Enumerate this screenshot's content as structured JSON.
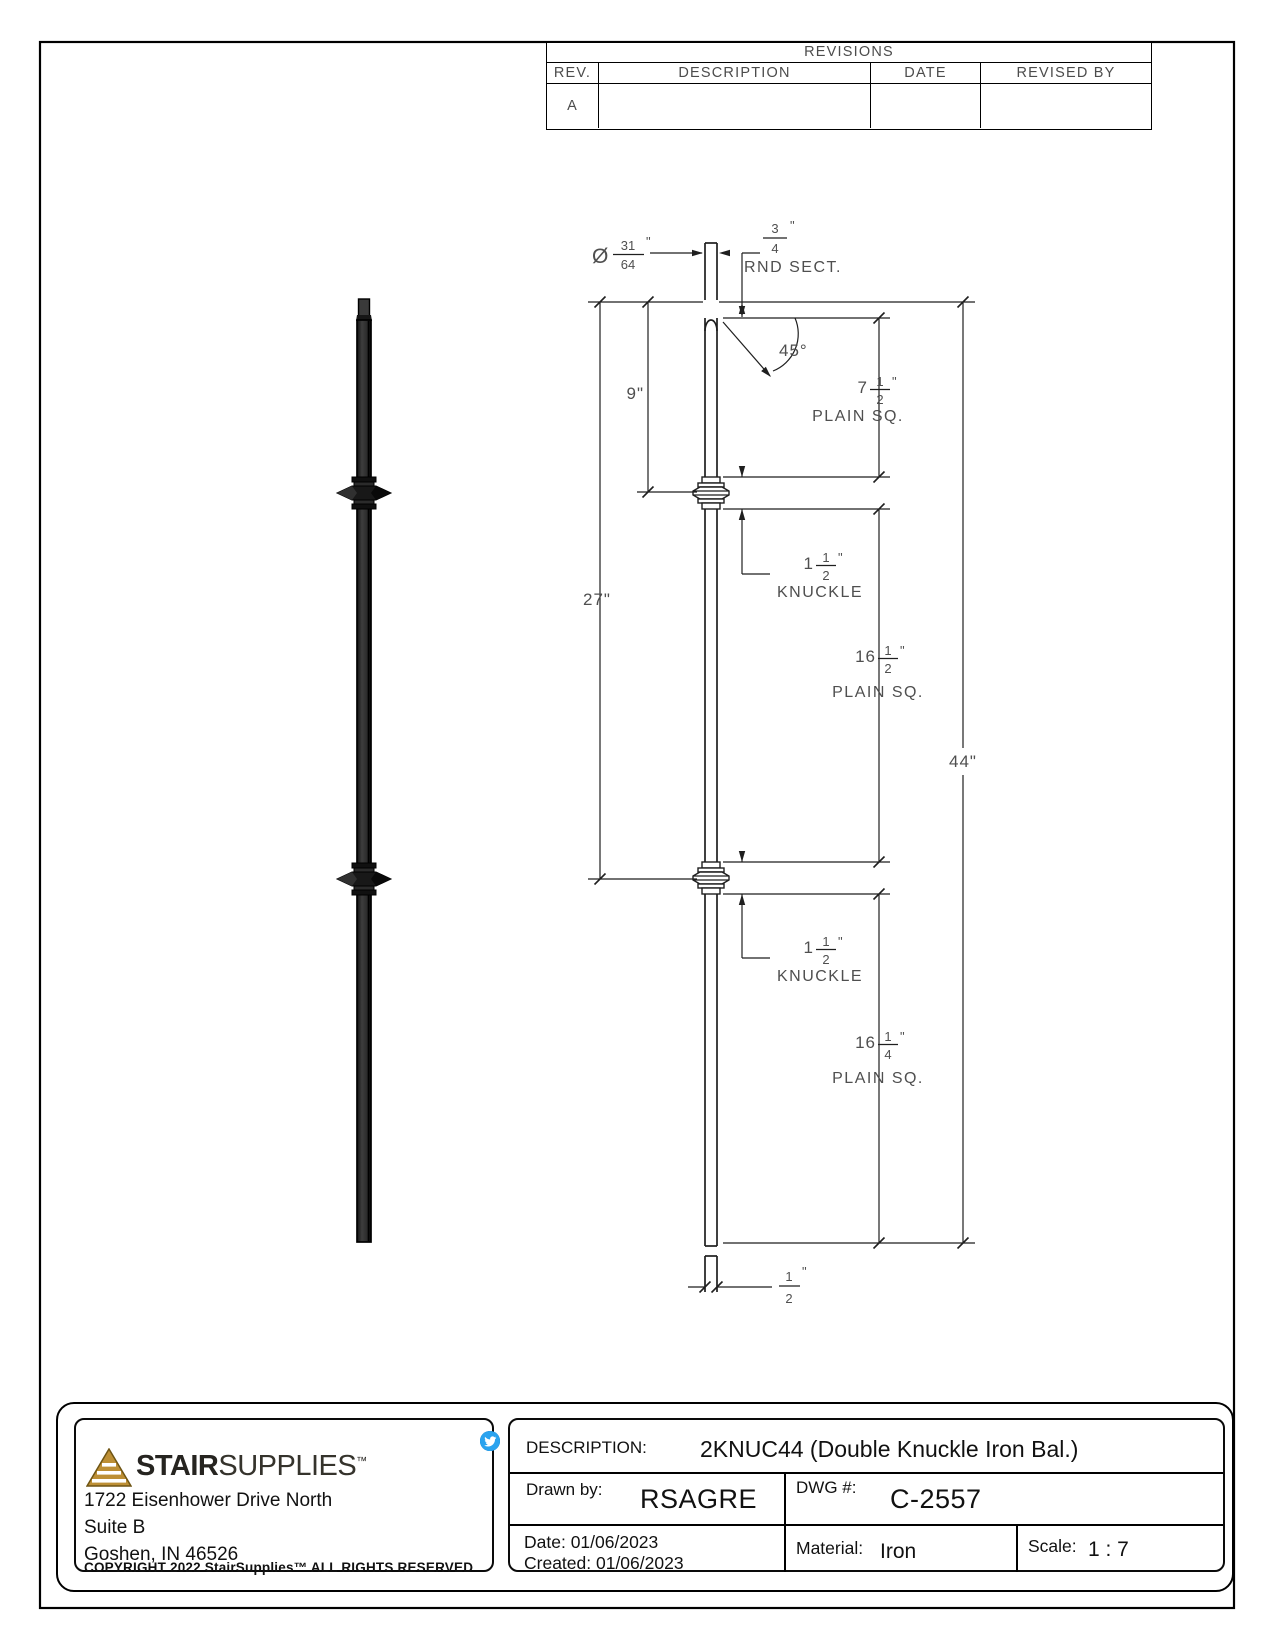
{
  "page": {
    "background": "#ffffff",
    "line_color": "#1f1f1f",
    "cad_text_color": "#4f4f4f"
  },
  "revisions_table": {
    "title": "REVISIONS",
    "columns": [
      "REV.",
      "DESCRIPTION",
      "DATE",
      "REVISED BY"
    ],
    "rows": [
      {
        "rev": "A",
        "description": "",
        "date": "",
        "revised_by": ""
      }
    ]
  },
  "drawing": {
    "dims": {
      "diameter": {
        "symbol": "Ø",
        "num": "31",
        "den": "64",
        "unit": "\""
      },
      "round_section": {
        "num": "3",
        "den": "4",
        "unit": "\"",
        "label": "RND SECT."
      },
      "angle": "45°",
      "nine": "9\"",
      "twentyseven": "27\"",
      "overall": "44\"",
      "plain_sq_top": {
        "whole": "7",
        "num": "1",
        "den": "2",
        "unit": "\"",
        "label": "PLAIN SQ."
      },
      "knuckle_upper": {
        "whole": "1",
        "num": "1",
        "den": "2",
        "unit": "\"",
        "label": "KNUCKLE"
      },
      "plain_sq_mid": {
        "whole": "16",
        "num": "1",
        "den": "2",
        "unit": "\"",
        "label": "PLAIN SQ."
      },
      "knuckle_lower": {
        "whole": "1",
        "num": "1",
        "den": "2",
        "unit": "\"",
        "label": "KNUCKLE"
      },
      "plain_sq_bottom": {
        "whole": "16",
        "num": "1",
        "den": "4",
        "unit": "\"",
        "label": "PLAIN SQ."
      },
      "bar_width": {
        "num": "1",
        "den": "2",
        "unit": "\""
      }
    }
  },
  "title_block": {
    "logo": {
      "brand_bold": "STAIR",
      "brand_light": "SUPPLIES",
      "tm": "™",
      "triangle_color": "#bd8f35"
    },
    "social_icons": [
      "facebook",
      "linkedin",
      "twitter"
    ],
    "social_colors": {
      "facebook": "#3b5998",
      "linkedin": "#0077b5",
      "twitter": "#2aa3ef"
    },
    "address_lines": [
      "1722 Eisenhower Drive North",
      "Suite B",
      "Goshen, IN 46526"
    ],
    "copyright": "COPYRIGHT 2022 StairSupplies™ ALL RIGHTS RESERVED",
    "fields": {
      "description_label": "DESCRIPTION:",
      "description_value": "2KNUC44 (Double Knuckle Iron Bal.)",
      "drawn_by_label": "Drawn by:",
      "drawn_by_value": "RSAGRE",
      "dwg_label": "DWG #:",
      "dwg_value": "C-2557",
      "date_label": "Date: 01/06/2023",
      "created_label": "Created: 01/06/2023",
      "material_label": "Material:",
      "material_value": "Iron",
      "scale_label": "Scale:",
      "scale_value": "1 : 7"
    }
  }
}
